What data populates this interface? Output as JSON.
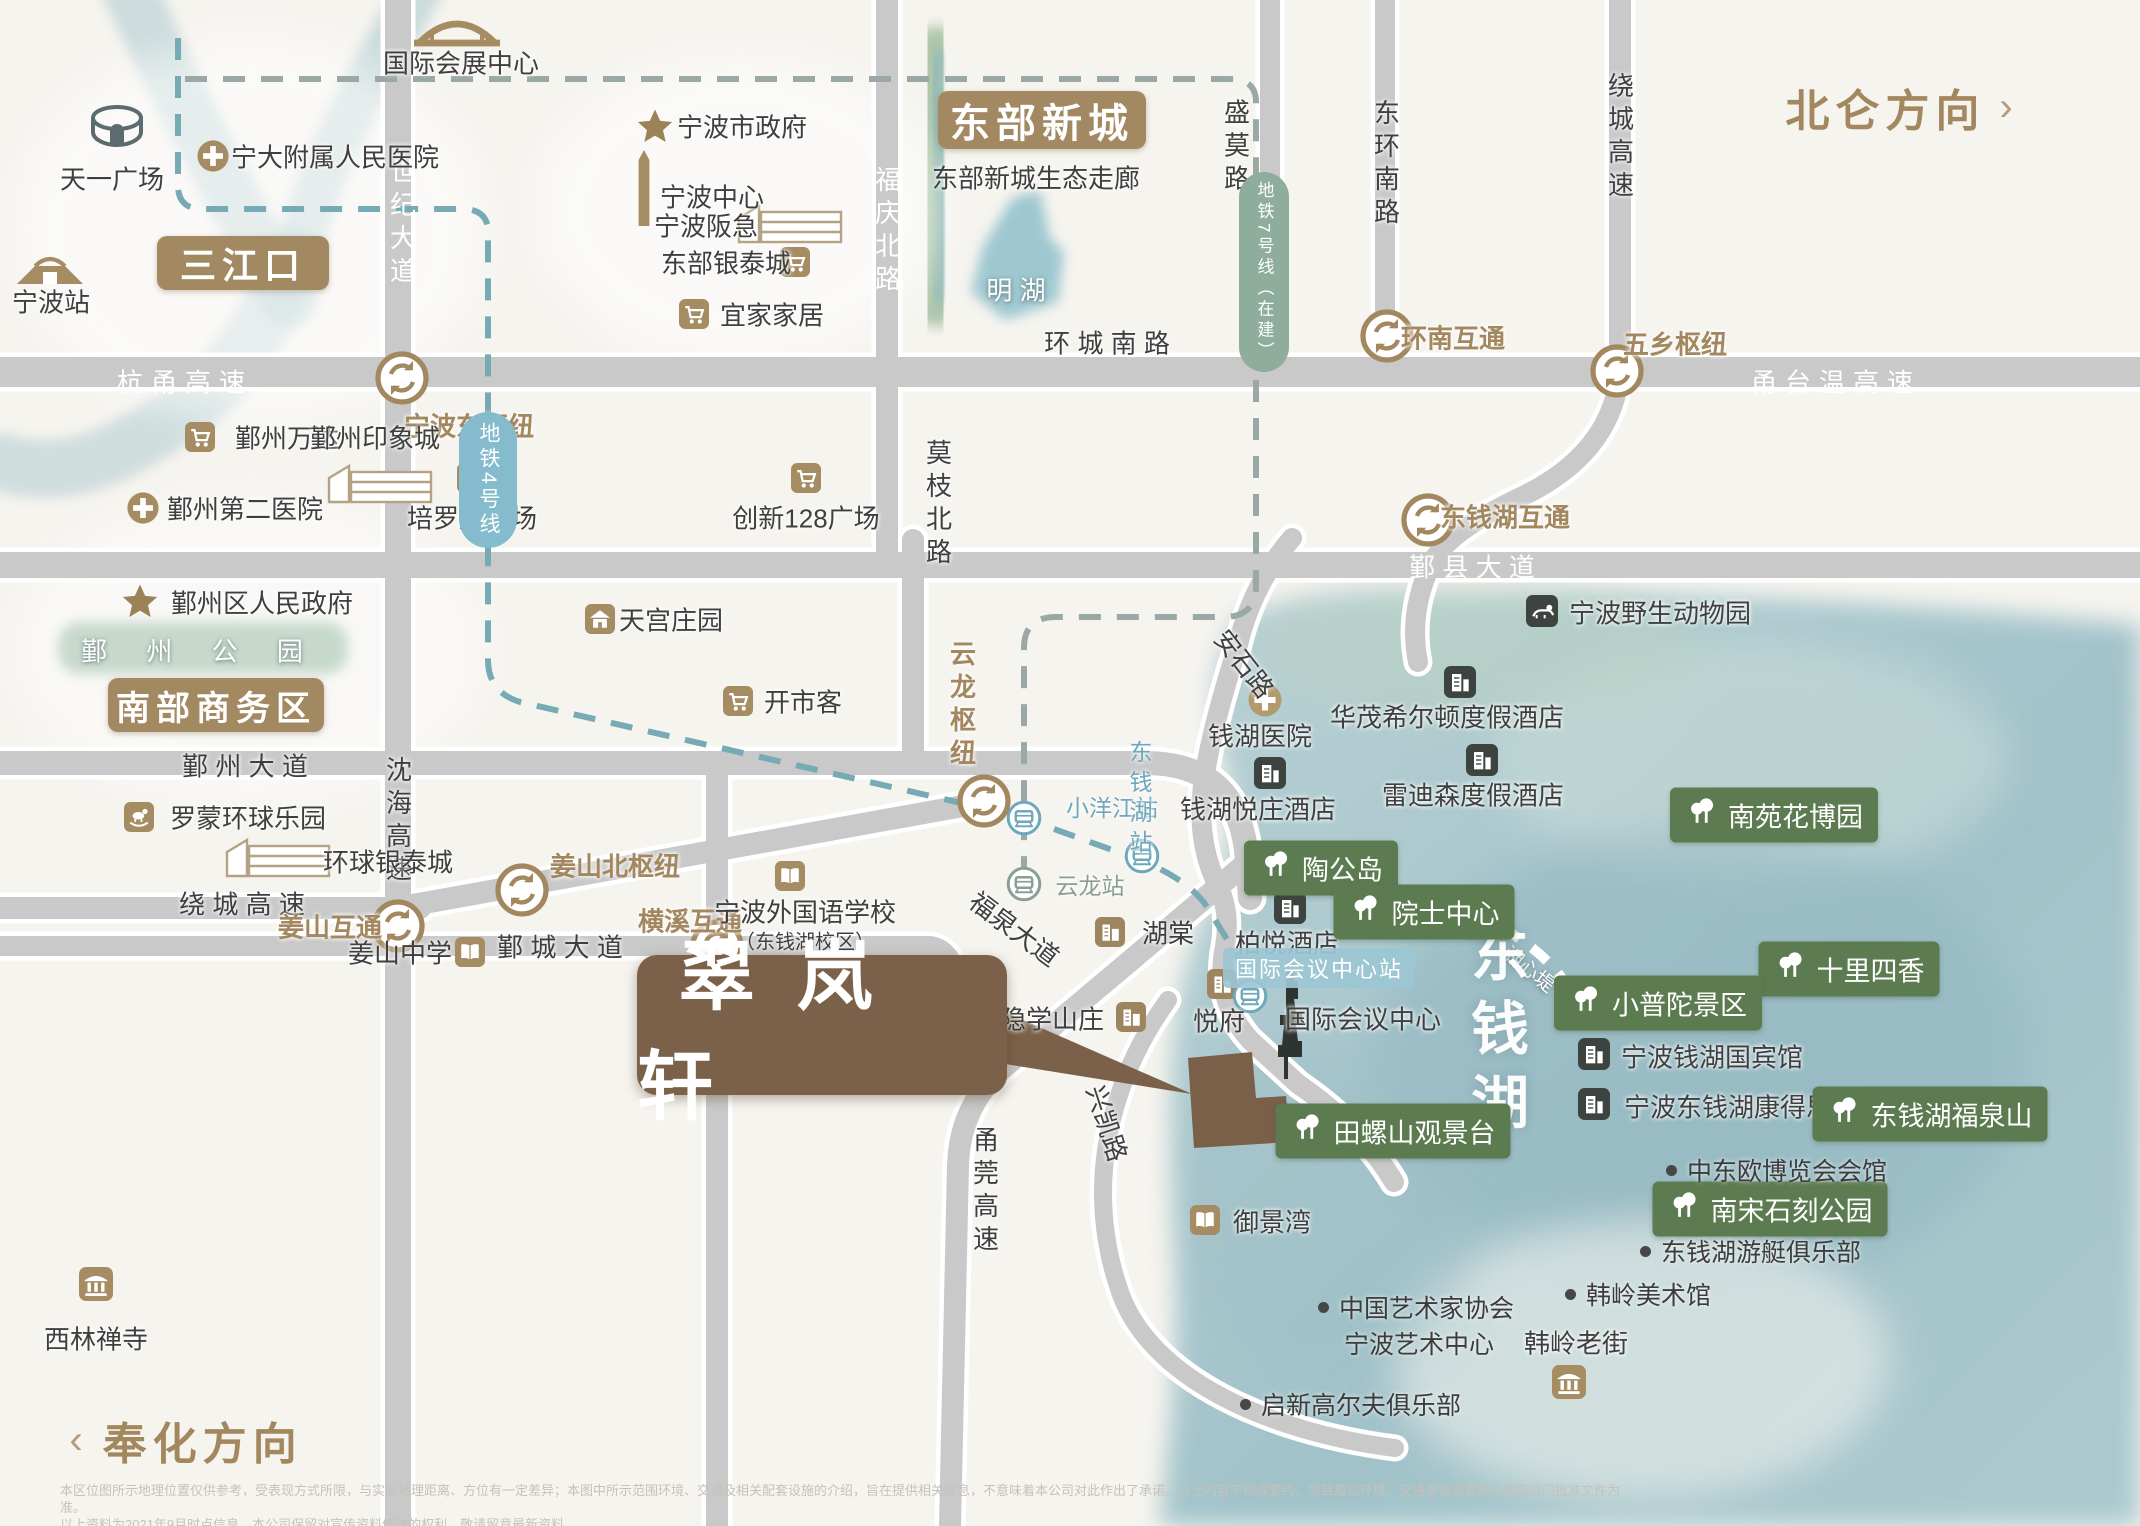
{
  "map": {
    "directions": [
      {
        "n": "beilun-direction",
        "t": "北仑方向",
        "chev": "›",
        "x": 1902,
        "y": 107,
        "side": "right"
      },
      {
        "n": "fenghua-direction",
        "t": "奉化方向",
        "chev": "‹",
        "x": 186,
        "y": 1440,
        "side": "left"
      }
    ],
    "property": {
      "n": "cuilanxuan",
      "t": "翠岚轩",
      "x": 637,
      "y": 955,
      "w": 370,
      "h": 140
    },
    "area_badges": [
      {
        "n": "sanjiangkou",
        "t": "三江口",
        "x": 243,
        "y": 263,
        "w": 172,
        "h": 54,
        "fz": 36
      },
      {
        "n": "eastern-newtown",
        "t": "东部新城",
        "x": 1042,
        "y": 120,
        "w": 208,
        "h": 58,
        "fz": 40
      },
      {
        "n": "southern-cbd",
        "t": "南部商务区",
        "x": 216,
        "y": 705,
        "w": 216,
        "h": 54,
        "fz": 34
      }
    ],
    "labels": [
      {
        "n": "hangyong-expwy",
        "t": "杭甬高速",
        "x": 185,
        "y": 381,
        "c": "w sp1"
      },
      {
        "n": "yongtaiwen-expwy",
        "t": "甬台温高速",
        "x": 1836,
        "y": 381,
        "c": "w sp1"
      },
      {
        "n": "huancheng-south-road",
        "t": "环 城 南 路",
        "x": 1107,
        "y": 342,
        "c": ""
      },
      {
        "n": "yinxian-avenue",
        "t": "鄞 县 大 道",
        "x": 1472,
        "y": 566,
        "c": "w"
      },
      {
        "n": "yinzhou-avenue",
        "t": "鄞 州 大 道",
        "x": 245,
        "y": 765,
        "c": ""
      },
      {
        "n": "raocheng-expwy-west",
        "t": "绕 城 高 速",
        "x": 242,
        "y": 903,
        "c": ""
      },
      {
        "n": "yincheng-avenue",
        "t": "鄞 城 大 道",
        "x": 560,
        "y": 946,
        "c": ""
      },
      {
        "n": "century-avenue",
        "t": "世纪大道",
        "x": 402,
        "y": 224,
        "c": "w vert"
      },
      {
        "n": "fuqing-north-road",
        "t": "福庆北路",
        "x": 887,
        "y": 232,
        "c": "w vert"
      },
      {
        "n": "shenhai-expwy",
        "t": "沈海高速",
        "x": 398,
        "y": 822,
        "c": "vert"
      },
      {
        "n": "yongguan-expwy",
        "t": "甬莞高速",
        "x": 985,
        "y": 1192,
        "c": "vert"
      },
      {
        "n": "shengmo-road",
        "t": "盛莫路",
        "x": 1236,
        "y": 148,
        "c": "vert"
      },
      {
        "n": "donghuan-south-road",
        "t": "东环南路",
        "x": 1386,
        "y": 165,
        "c": "vert"
      },
      {
        "n": "raocheng-expwy-north",
        "t": "绕城高速",
        "x": 1620,
        "y": 138,
        "c": "vert"
      },
      {
        "n": "mozhi-north-road",
        "t": "莫枝北路",
        "x": 938,
        "y": 505,
        "c": "vert"
      },
      {
        "n": "anshi-road",
        "t": "安石路",
        "x": 1245,
        "y": 663,
        "c": "",
        "rot": 52
      },
      {
        "n": "fuquan-avenue",
        "t": "福泉大道",
        "x": 1015,
        "y": 928,
        "c": "",
        "rot": 37
      },
      {
        "n": "xingkai-road",
        "t": "兴凯路",
        "x": 1108,
        "y": 1123,
        "c": "",
        "rot": 72
      },
      {
        "n": "yunlong-hub-label",
        "t": "云龙枢纽",
        "x": 962,
        "y": 706,
        "c": "brown vert"
      },
      {
        "n": "ningbo-east-hub",
        "t": "宁波东枢纽",
        "x": 469,
        "y": 425,
        "c": "brown"
      },
      {
        "n": "huannan-interchange-label",
        "t": "环南互通",
        "x": 1453,
        "y": 337,
        "c": "brown"
      },
      {
        "n": "wuxiang-hub-label",
        "t": "五乡枢纽",
        "x": 1675,
        "y": 343,
        "c": "brown"
      },
      {
        "n": "dongqianhu-interchange-label",
        "t": "东钱湖互通",
        "x": 1505,
        "y": 516,
        "c": "brown"
      },
      {
        "n": "jiangshan-north-hub-label",
        "t": "姜山北枢纽",
        "x": 615,
        "y": 865,
        "c": "brown"
      },
      {
        "n": "jiangshan-interchange-label",
        "t": "姜山互通",
        "x": 330,
        "y": 926,
        "c": "brown"
      },
      {
        "n": "hengxi-interchange-label",
        "t": "横溪互通",
        "x": 690,
        "y": 920,
        "c": "brown"
      },
      {
        "n": "eco-corridor",
        "t": "东部新城生态走廊",
        "x": 1036,
        "y": 177,
        "c": ""
      },
      {
        "n": "minghu-lake",
        "t": "明 湖",
        "x": 1016,
        "y": 289,
        "c": "wdk"
      },
      {
        "n": "icc-label",
        "t": "国际会议中心",
        "x": 1363,
        "y": 1018,
        "c": ""
      },
      {
        "n": "nbfls-line1",
        "t": "宁波外国语学校",
        "x": 805,
        "y": 911,
        "c": ""
      },
      {
        "n": "nbfls-line2",
        "t": "（东钱湖校区）",
        "x": 805,
        "y": 940,
        "c": "small"
      },
      {
        "n": "hanling-old-street",
        "t": "韩岭老街",
        "x": 1576,
        "y": 1342,
        "c": ""
      },
      {
        "n": "huxindi-trail",
        "t": "湖心堤",
        "x": 1530,
        "y": 968,
        "c": "wdk small",
        "rot": 38
      },
      {
        "n": "dongqian-lake-label",
        "t": "东钱湖",
        "x": 1494,
        "y": 1035,
        "c": "biglake"
      }
    ],
    "pois": [
      {
        "n": "tianyi-square",
        "icon": "stadium",
        "t": "天一广场",
        "x": 117,
        "y": 126,
        "lx": 112,
        "ly": 178
      },
      {
        "n": "ningbo-station",
        "icon": "railstation",
        "t": "宁波站",
        "x": 50,
        "y": 268,
        "lx": 51,
        "ly": 301
      },
      {
        "n": "ningda-hospital",
        "icon": "cross",
        "t": "宁大附属人民医院",
        "x": 213,
        "y": 156,
        "lx": 335,
        "ly": 156
      },
      {
        "n": "intl-expo-center",
        "icon": "bridge",
        "t": "国际会展中心",
        "x": 457,
        "y": 33,
        "lx": 461,
        "ly": 62
      },
      {
        "n": "ningbo-gov",
        "icon": "star",
        "t": "宁波市政府",
        "x": 655,
        "y": 127,
        "lx": 742,
        "ly": 126
      },
      {
        "n": "ningbo-center",
        "icon": "tower",
        "t": "宁波中心",
        "x": 644,
        "y": 188,
        "lx": 712,
        "ly": 196
      },
      {
        "n": "ningbo-hankyu",
        "icon": "sketch",
        "t": "宁波阪急",
        "x": 790,
        "y": 224,
        "lx": 706,
        "ly": 225
      },
      {
        "n": "eastern-intime",
        "icon": "cart",
        "t": "东部银泰城",
        "x": 795,
        "y": 262,
        "lx": 726,
        "ly": 262
      },
      {
        "n": "ikea",
        "icon": "cart",
        "t": "宜家家居",
        "x": 694,
        "y": 314,
        "lx": 772,
        "ly": 314
      },
      {
        "n": "yinzhou-wanda",
        "icon": "cart",
        "t": "鄞州万达",
        "x": 200,
        "y": 437,
        "lx": 287,
        "ly": 437
      },
      {
        "n": "yinzhou-impression-city",
        "icon": "sketch",
        "t": "鄞州印象城",
        "x": 380,
        "y": 484,
        "lx": 375,
        "ly": 437
      },
      {
        "n": "yinzhou-no2-hospital",
        "icon": "cross",
        "t": "鄞州第二医院",
        "x": 143,
        "y": 508,
        "lx": 245,
        "ly": 508
      },
      {
        "n": "yinzhou-gov",
        "icon": "star",
        "t": "鄞州区人民政府",
        "x": 140,
        "y": 602,
        "lx": 262,
        "ly": 602
      },
      {
        "n": "peiluocheng-plaza",
        "icon": "cart",
        "t": "培罗成广场",
        "x": 472,
        "y": 478,
        "lx": 472,
        "ly": 517
      },
      {
        "n": "innovation-128-plaza",
        "icon": "cart",
        "t": "创新128广场",
        "x": 806,
        "y": 478,
        "lx": 806,
        "ly": 517
      },
      {
        "n": "tiangong-manor",
        "icon": "housetan",
        "t": "天宫庄园",
        "x": 600,
        "y": 619,
        "lx": 671,
        "ly": 619
      },
      {
        "n": "costco",
        "icon": "cart",
        "t": "开市客",
        "x": 738,
        "y": 701,
        "lx": 803,
        "ly": 701
      },
      {
        "n": "lomon-universal-park",
        "icon": "horse",
        "t": "罗蒙环球乐园",
        "x": 139,
        "y": 817,
        "lx": 248,
        "ly": 817
      },
      {
        "n": "universal-intime",
        "icon": "sketch",
        "t": "环球银泰城",
        "x": 278,
        "y": 858,
        "lx": 388,
        "ly": 861
      },
      {
        "n": "jiangshan-middle-school",
        "icon": "book",
        "t": "姜山中学",
        "x": 470,
        "y": 952,
        "lx": 400,
        "ly": 952
      },
      {
        "n": "ningbo-foreign-language-school",
        "icon": "book",
        "t": "",
        "x": 790,
        "y": 876,
        "lx": 0,
        "ly": 0
      },
      {
        "n": "xilin-temple",
        "icon": "temple",
        "t": "西林禅寺",
        "x": 96,
        "y": 1284,
        "lx": 96,
        "ly": 1338
      },
      {
        "n": "qianhu-hospital",
        "icon": "crosstan",
        "t": "钱湖医院",
        "x": 1265,
        "y": 700,
        "lx": 1260,
        "ly": 735
      },
      {
        "n": "qianhu-yuezhuang-hotel",
        "icon": "hotel",
        "t": "钱湖悦庄酒店",
        "x": 1270,
        "y": 773,
        "lx": 1258,
        "ly": 808
      },
      {
        "n": "hilton-resort",
        "icon": "hotel",
        "t": "华茂希尔顿度假酒店",
        "x": 1460,
        "y": 682,
        "lx": 1447,
        "ly": 716
      },
      {
        "n": "radisson-resort",
        "icon": "hotel",
        "t": "雷迪森度假酒店",
        "x": 1482,
        "y": 760,
        "lx": 1473,
        "ly": 794
      },
      {
        "n": "park-hyatt-hotel",
        "icon": "hotel",
        "t": "柏悦酒店",
        "x": 1290,
        "y": 908,
        "lx": 1287,
        "ly": 942
      },
      {
        "n": "qianhu-state-guesthouse",
        "icon": "hotel",
        "t": "宁波钱湖国宾馆",
        "x": 1594,
        "y": 1054,
        "lx": 1712,
        "ly": 1056
      },
      {
        "n": "cordis-hotel",
        "icon": "hotel",
        "t": "宁波东钱湖康得思酒店",
        "x": 1594,
        "y": 1104,
        "lx": 1754,
        "ly": 1106
      },
      {
        "n": "wildlife-park",
        "icon": "animal",
        "t": "宁波野生动物园",
        "x": 1542,
        "y": 611,
        "lx": 1660,
        "ly": 612
      },
      {
        "n": "hutang",
        "icon": "bldgbrown",
        "t": "湖棠",
        "x": 1110,
        "y": 932,
        "lx": 1168,
        "ly": 932
      },
      {
        "n": "yuefu",
        "icon": "bldgbrown",
        "t": "悦府",
        "x": 1222,
        "y": 984,
        "lx": 1219,
        "ly": 1020
      },
      {
        "n": "yinxue-villa",
        "icon": "bldgbrown",
        "t": "隐学山庄",
        "x": 1131,
        "y": 1017,
        "lx": 1052,
        "ly": 1018
      },
      {
        "n": "intl-conference-center",
        "icon": "congress",
        "t": "",
        "x": 1290,
        "y": 1025,
        "lx": 0,
        "ly": 0
      },
      {
        "n": "yujingwan",
        "icon": "book",
        "t": "御景湾",
        "x": 1205,
        "y": 1220,
        "lx": 1272,
        "ly": 1221
      },
      {
        "n": "hanling-pavilion",
        "icon": "temple",
        "t": "",
        "x": 1569,
        "y": 1382,
        "lx": 0,
        "ly": 0
      }
    ],
    "stations": [
      {
        "n": "xiaoyangjiang-station",
        "t": "小洋江站",
        "x": 1024,
        "y": 818,
        "lx": 1112,
        "ly": 806,
        "c": "blue"
      },
      {
        "n": "dongqianhu-station",
        "t": "东钱湖站",
        "x": 1142,
        "y": 856,
        "lx": 1139,
        "ly": 800,
        "c": "blue vert"
      },
      {
        "n": "yunlong-station",
        "t": "云龙站",
        "x": 1024,
        "y": 884,
        "lx": 1090,
        "ly": 884,
        "c": "green"
      }
    ],
    "icc_station": {
      "n": "icc-station",
      "t": "国际会议中心站",
      "x": 1319,
      "y": 968,
      "ix": 1250,
      "iy": 996
    },
    "interchanges": [
      {
        "n": "shiji-hangyong-interchange",
        "x": 402,
        "y": 378
      },
      {
        "n": "huannan-interchange",
        "x": 1387,
        "y": 336
      },
      {
        "n": "wuxiang-hub",
        "x": 1617,
        "y": 371
      },
      {
        "n": "dongqianhu-interchange",
        "x": 1428,
        "y": 520
      },
      {
        "n": "jiangshan-interchange",
        "x": 398,
        "y": 926
      },
      {
        "n": "hengxi-interchange",
        "x": 717,
        "y": 946
      },
      {
        "n": "jiangshan-north-hub",
        "x": 522,
        "y": 890
      },
      {
        "n": "yunlong-hub",
        "x": 984,
        "y": 801
      }
    ],
    "pills": [
      {
        "n": "metro-line4",
        "t": "地铁4号线",
        "x": 488,
        "y": 480,
        "w": 58,
        "h": 136,
        "bg": "#85bccd"
      },
      {
        "n": "metro-line7",
        "t": "地铁7号线（在建）",
        "x": 1264,
        "y": 272,
        "w": 50,
        "h": 200,
        "bg": "#8fad9c"
      }
    ],
    "green_badges": [
      {
        "n": "taogong-island",
        "t": "陶公岛",
        "x": 1321,
        "y": 868
      },
      {
        "n": "academician-center",
        "t": "院士中心",
        "x": 1424,
        "y": 912
      },
      {
        "n": "tianluoshan-viewpoint",
        "t": "田螺山观景台",
        "x": 1393,
        "y": 1131
      },
      {
        "n": "nanyuan-flower-expo",
        "t": "南苑花博园",
        "x": 1774,
        "y": 815
      },
      {
        "n": "shilisixiang",
        "t": "十里四香",
        "x": 1849,
        "y": 969
      },
      {
        "n": "xiaoputuo-scenic",
        "t": "小普陀景区",
        "x": 1658,
        "y": 1003
      },
      {
        "n": "dongqianhu-fuquanshan",
        "t": "东钱湖福泉山",
        "x": 1930,
        "y": 1114
      },
      {
        "n": "southern-song-stone-carving-park",
        "t": "南宋石刻公园",
        "x": 1770,
        "y": 1209
      }
    ],
    "bullets": [
      {
        "n": "ceec-expo-hall",
        "t": "中东欧博览会会馆",
        "x": 1666,
        "y": 1170
      },
      {
        "n": "yacht-club",
        "t": "东钱湖游艇俱乐部",
        "x": 1640,
        "y": 1251
      },
      {
        "n": "hanling-art-museum",
        "t": "韩岭美术馆",
        "x": 1565,
        "y": 1294
      },
      {
        "n": "qixin-golf-club",
        "t": "启新高尔夫俱乐部",
        "x": 1240,
        "y": 1404
      },
      {
        "n": "artists-association",
        "t": "中国艺术家协会",
        "x": 1318,
        "y": 1307
      },
      {
        "n": "ningbo-art-center",
        "t": "宁波艺术中心",
        "x": 1344,
        "y": 1343,
        "nodot": true
      }
    ],
    "zone_labels": [
      {
        "n": "yinzhou-park",
        "t": "鄞 州 公 园",
        "x": 200,
        "y": 650
      }
    ],
    "disclaimer": [
      "本区位图所示地理位置仅供参考，受表现方式所限，与实际地理距离、方位有一定差异；本图中所示范围环境、交通及相关配套设施的介绍，旨在提供相关信息，不意味着本公司对此作出了承诺。以上内容不构成要约，项目周边环境、交通等信息最终以政府部门批准文件为准。",
      "以上资料为2021年9月时点信息，本公司保留对宣传资料修改的权利，敬请留意最新资料。"
    ],
    "colors": {
      "road": "#c9c9c9",
      "tan": "#a58c63",
      "darkicon": "#3d443f",
      "greenbadge": "#5d7b50",
      "brown": "#a3875f",
      "propbrown": "#7c614a",
      "metroteal": "#76aab4",
      "metrogray": "#9aa8a6",
      "stationblue": "#6fa7bd",
      "stationgreen": "#8a9e94",
      "lake": "#a5c5cb"
    }
  }
}
